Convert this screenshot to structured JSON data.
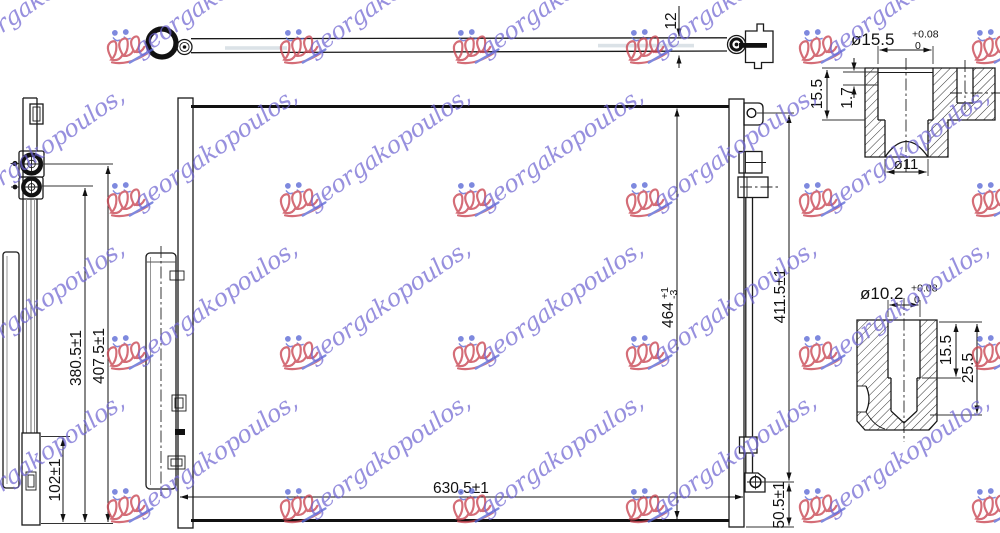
{
  "watermark": {
    "text": "georgakopoulos,"
  },
  "colors": {
    "watermark_text": "#7066d2",
    "watermark_logo_red": "#c94552",
    "watermark_logo_blue": "#5a68d6"
  },
  "views": {
    "tube": {
      "dim_12": "12"
    },
    "side": {
      "dim_102": "102±1",
      "dim_380": "380.5±1",
      "dim_407": "407.5±1"
    },
    "front": {
      "dim_464": "464",
      "dim_464_tol_plus": "+1",
      "dim_464_tol_minus": "-3",
      "dim_630": "630.5±1",
      "dim_411": "411.5±1",
      "dim_50": "50.5±1"
    },
    "detail_top": {
      "dia": "ø15.5",
      "tol_plus": "+0.08",
      "tol_zero": "0",
      "height": "15.5",
      "lip": "1.7",
      "hole": "ø11"
    },
    "detail_bottom": {
      "dia": "ø10.2",
      "tol_plus": "+0.08",
      "tol_zero": "0",
      "depth_inner": "15.5",
      "depth_outer": "25.5"
    }
  }
}
